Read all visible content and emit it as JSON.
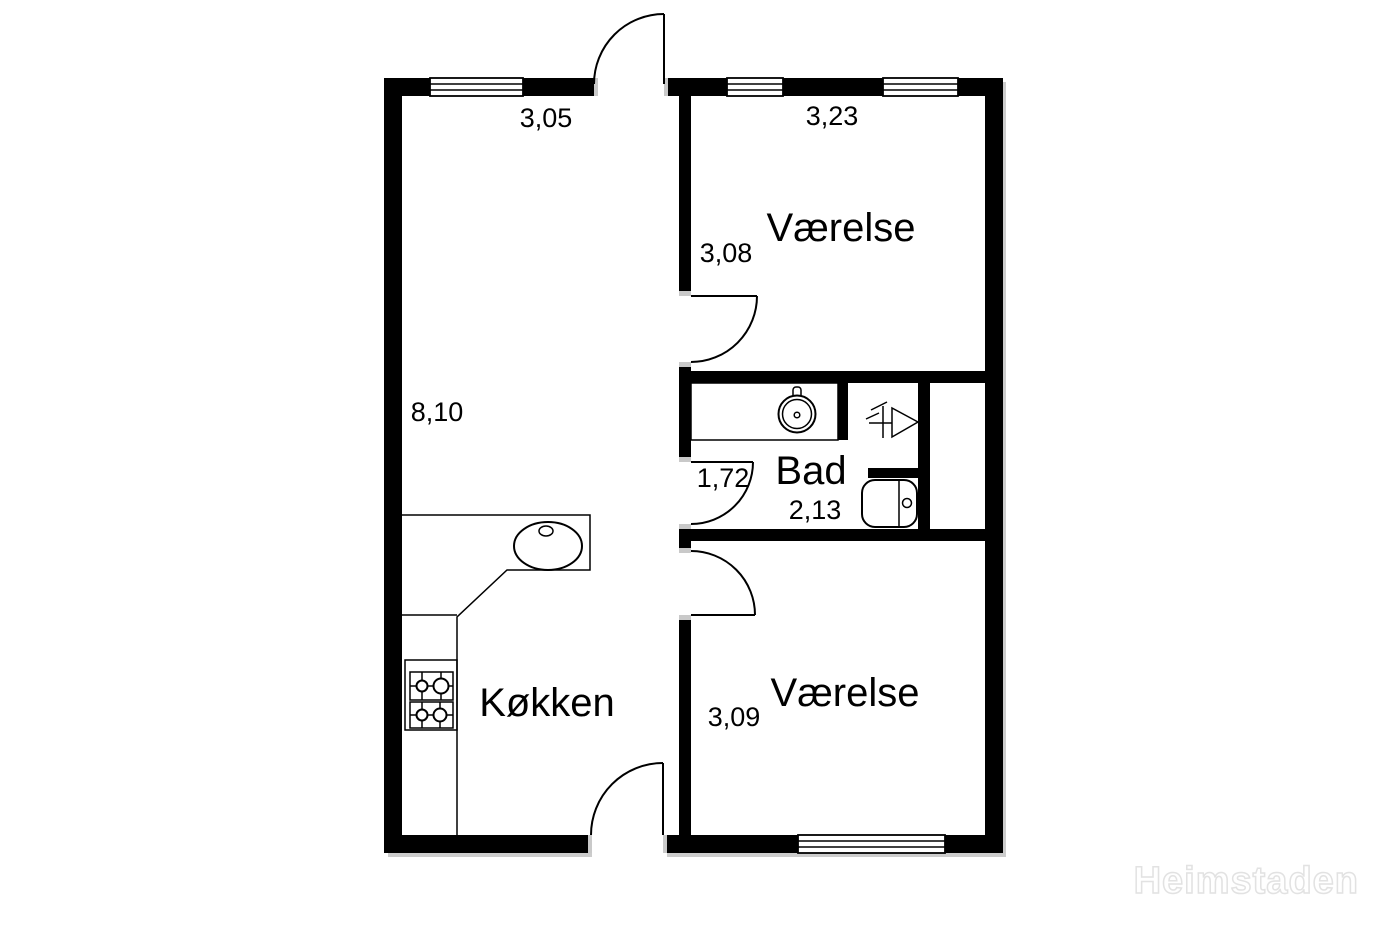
{
  "plan": {
    "watermark": "Heimstaden",
    "colors": {
      "wall": "#000000",
      "background": "#ffffff",
      "door_jamb": "#c9c9c9",
      "shadow": "#cccccc",
      "text": "#000000",
      "watermark_outline": "#e2e2e2"
    },
    "rooms": {
      "living": {
        "width": "3,05",
        "length": "8,10"
      },
      "room_top": {
        "label": "Værelse",
        "width": "3,23",
        "depth": "3,08"
      },
      "bath": {
        "label": "Bad",
        "width": "1,72",
        "depth": "2,13"
      },
      "kitchen": {
        "label": "Køkken"
      },
      "room_bottom": {
        "label": "Værelse",
        "depth": "3,09"
      }
    },
    "fixtures": {
      "bath_sink": "round-basin-on-counter",
      "shower": "shower-drain-symbol",
      "toilet": "toilet",
      "kitchen_sink": "oval-sink",
      "stove": "four-burner-stove",
      "counter": "kitchen-counter"
    }
  }
}
